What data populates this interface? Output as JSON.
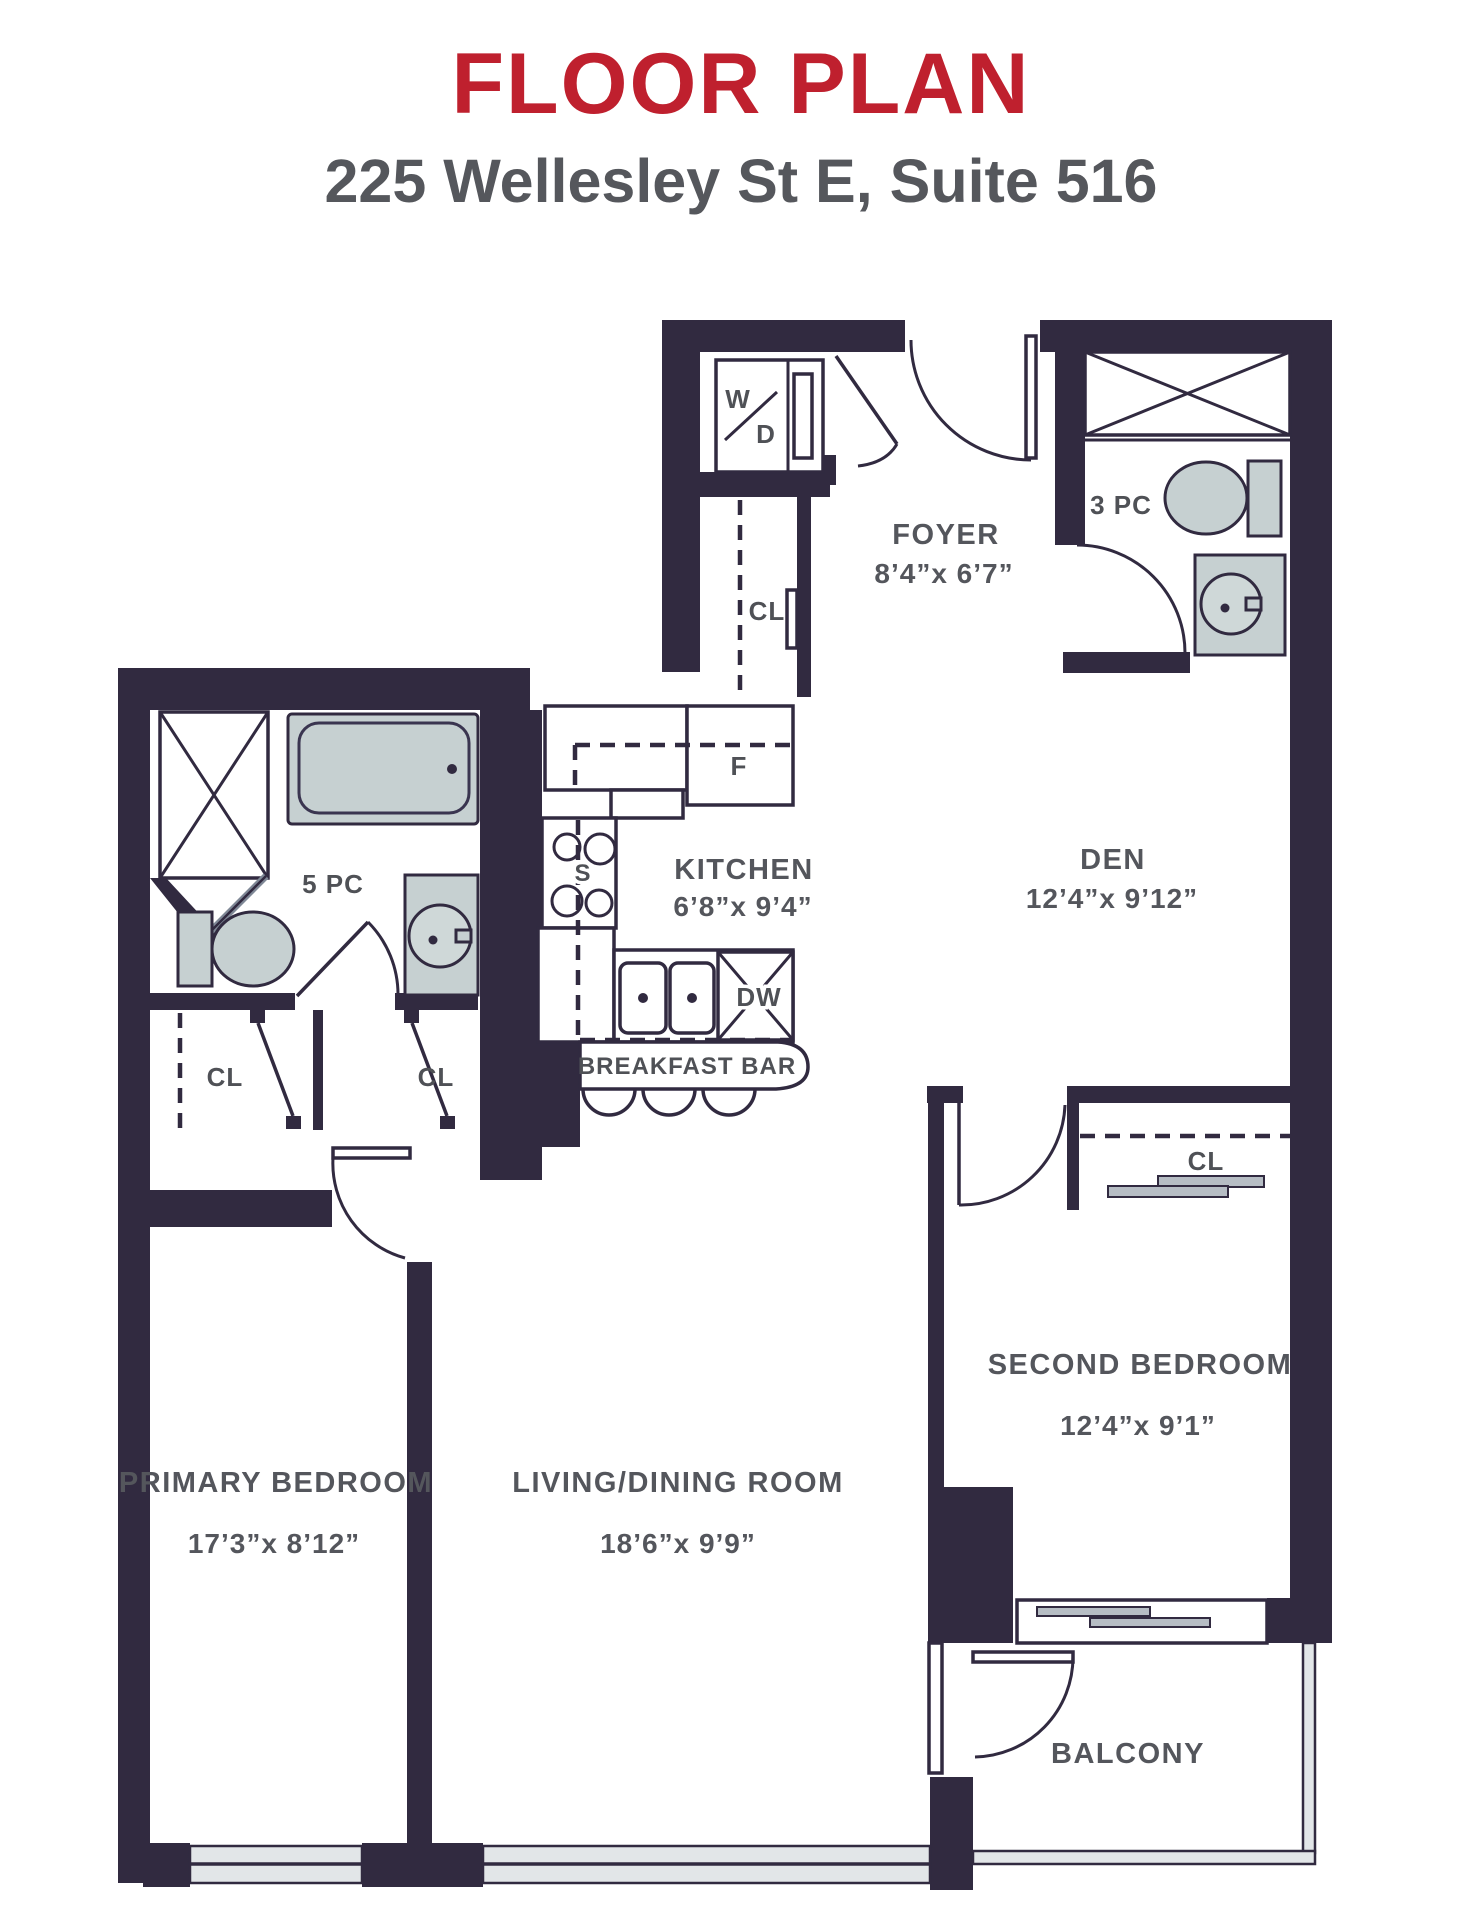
{
  "header": {
    "title": "FLOOR PLAN",
    "subtitle": "225 Wellesley St E, Suite 516"
  },
  "colors": {
    "accent_red": "#bf202e",
    "wall": "#312a40",
    "fixture_fill": "#c6d0d1",
    "label_gray": "#54565c",
    "window_fill": "#e2e6e8"
  },
  "rooms": {
    "foyer": {
      "name": "FOYER",
      "dims": "8’4”x 6’7”"
    },
    "bath3pc": {
      "name": "3 PC"
    },
    "den": {
      "name": "DEN",
      "dims": "12’4”x 9’12”"
    },
    "kitchen": {
      "name": "KITCHEN",
      "dims": "6’8”x 9’4”"
    },
    "bath5pc": {
      "name": "5 PC"
    },
    "breakfast_bar": {
      "name": "BREAKFAST BAR"
    },
    "primary_bedroom": {
      "name": "PRIMARY BEDROOM",
      "dims": "17’3”x 8’12”"
    },
    "living_dining": {
      "name": "LIVING/DINING ROOM",
      "dims": "18’6”x 9’9”"
    },
    "second_bedroom": {
      "name": "SECOND BEDROOM",
      "dims": "12’4”x 9’1”"
    },
    "balcony": {
      "name": "BALCONY"
    }
  },
  "appliances": {
    "washer": "W",
    "dryer": "D",
    "fridge": "F",
    "stove": "S",
    "dishwasher": "DW"
  },
  "labels": {
    "closet": "CL"
  }
}
